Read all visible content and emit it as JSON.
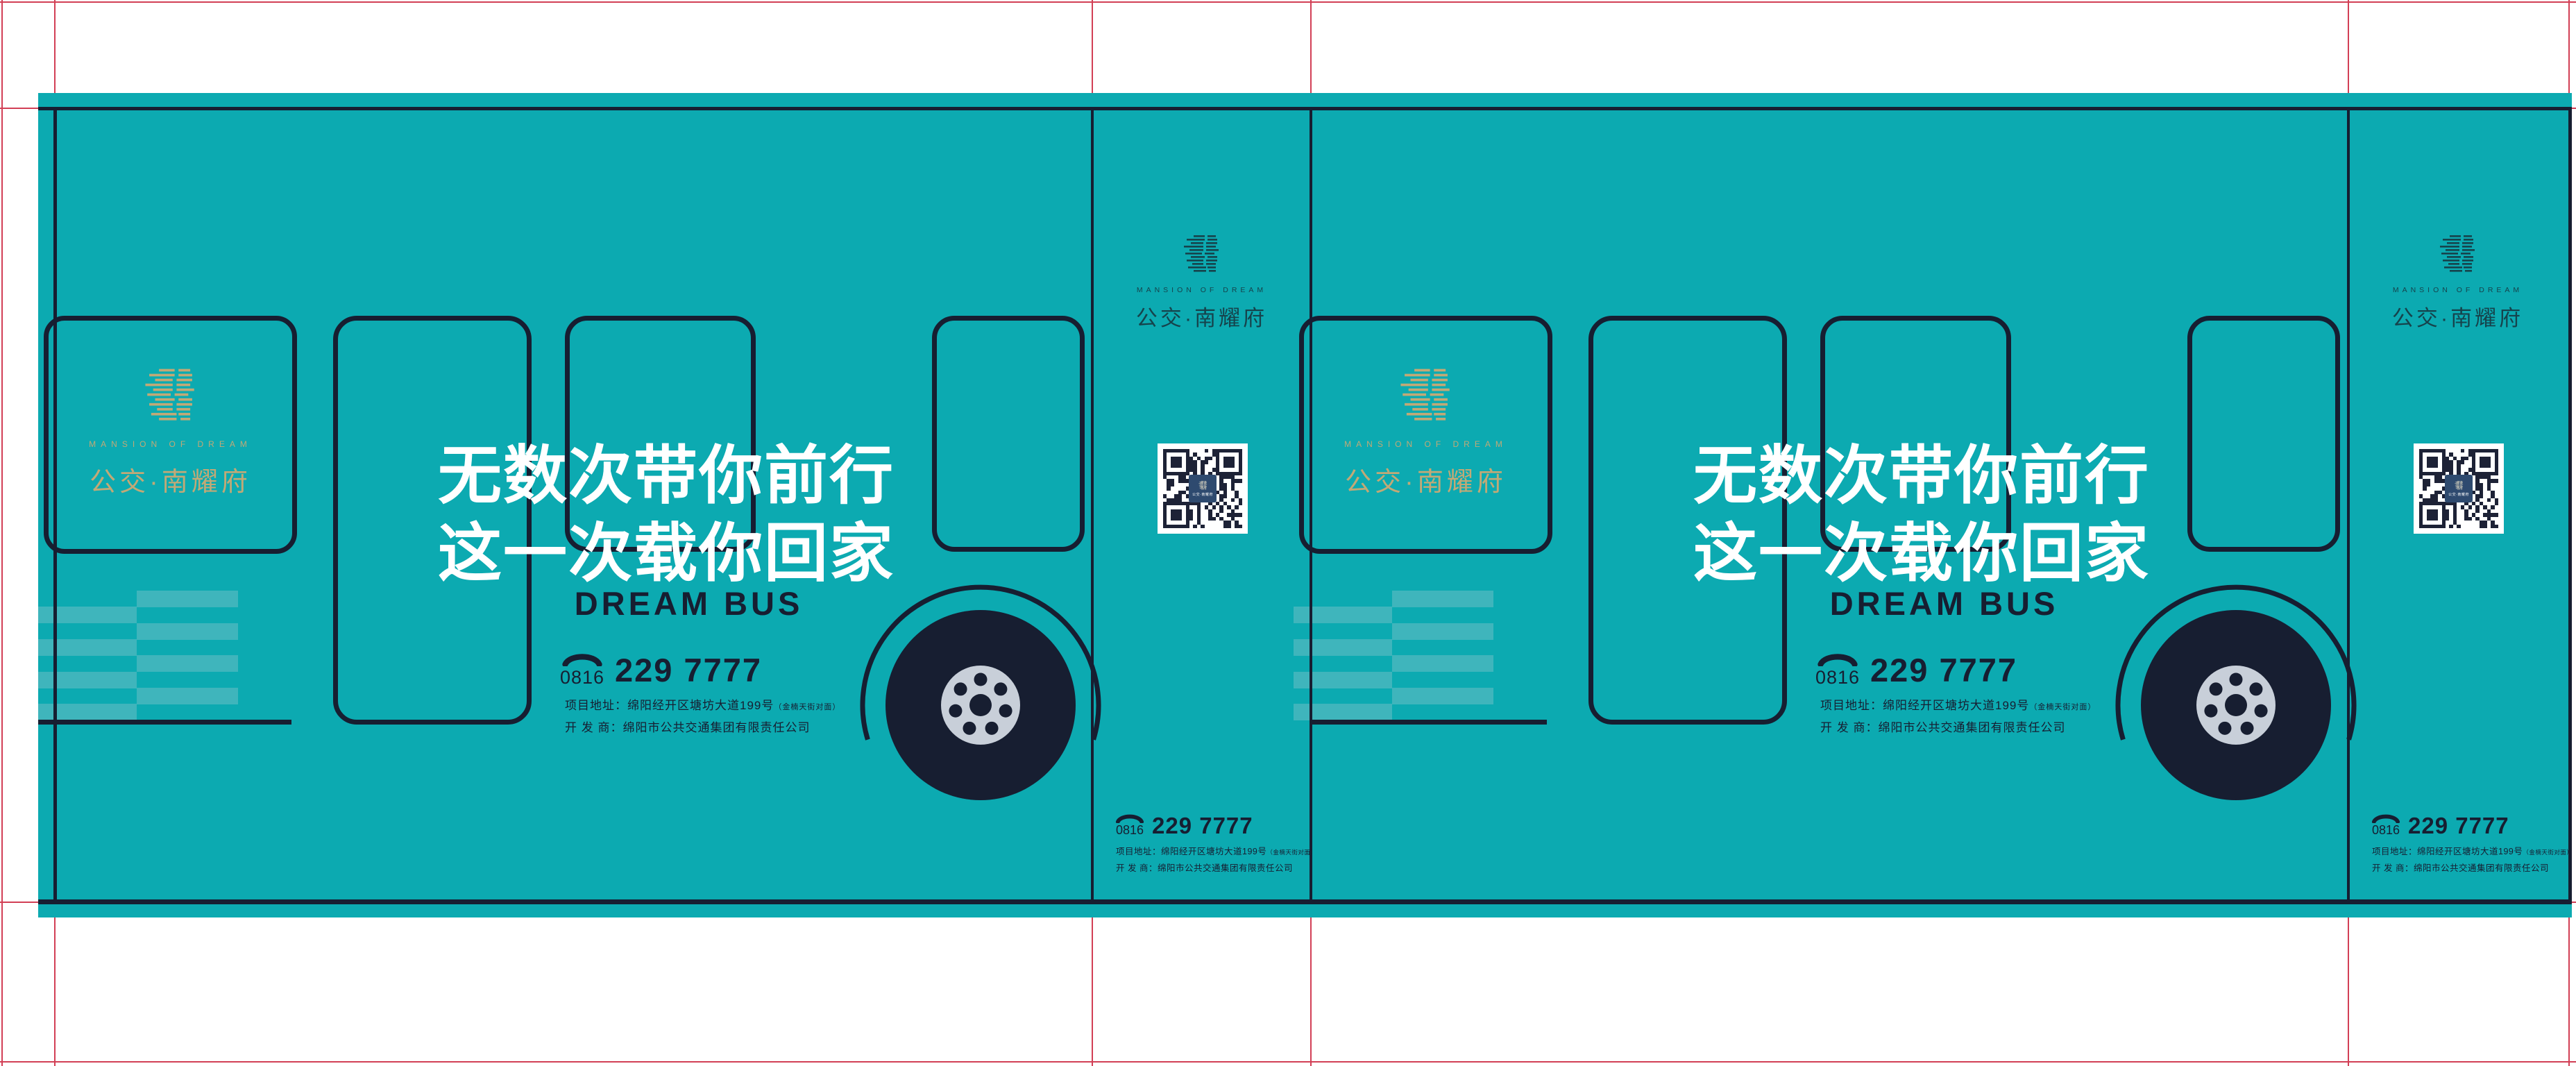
{
  "brand": {
    "name_en": "MANSION OF DREAM",
    "name_cn": "公交·南耀府",
    "logo_icon": "stacked-lines-mansion-mark"
  },
  "panel": {
    "headline1": "无数次带你前行",
    "headline2": "这一次载你回家",
    "subtitle": "DREAM BUS"
  },
  "contact": {
    "area_code": "0816",
    "number": "229 7777",
    "address": "项目地址：绵阳经开区塘坊大道199号",
    "address_note": "（金楠天街对面）",
    "developer": "开 发 商：绵阳市公共交通集团有限责任公司"
  },
  "colors": {
    "teal": "#0caab1",
    "navy": "#171e31",
    "stripe_light": "#3fb5bc",
    "gold": "#c2a976",
    "strip_logo": "#16434c",
    "crop_mark_red": "#d23f55",
    "hub_gray": "#c8cfd9",
    "qr_badge_blue": "#2e4a6f",
    "headline_white": "#ffffff"
  }
}
